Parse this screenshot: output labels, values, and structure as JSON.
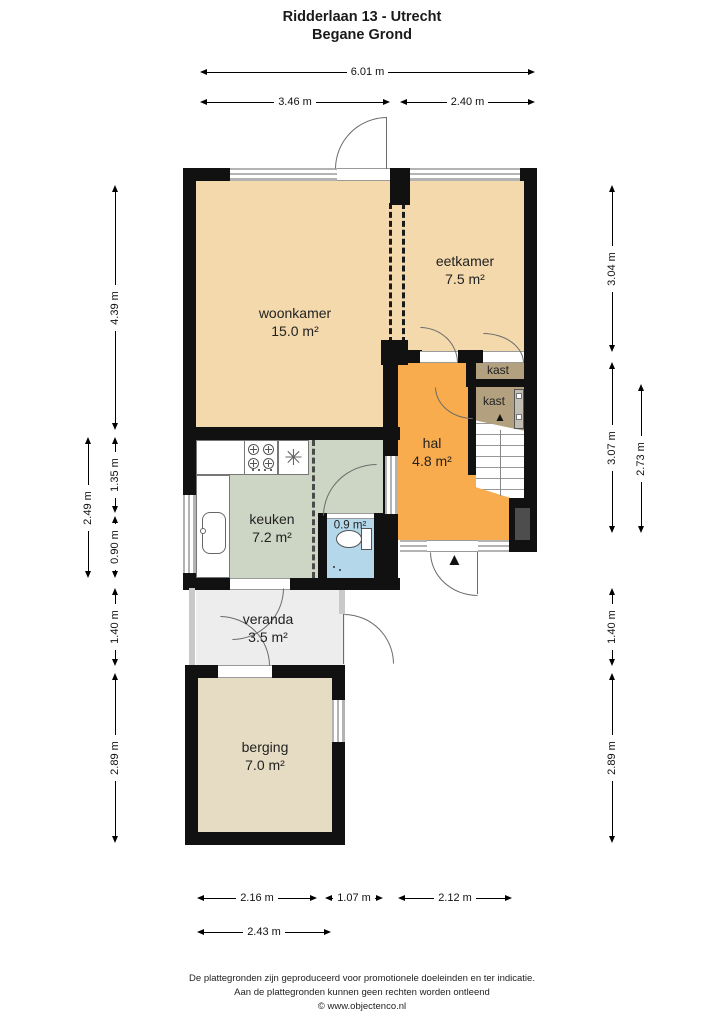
{
  "title": {
    "line1": "Ridderlaan 13 - Utrecht",
    "line2": "Begane Grond"
  },
  "rooms": {
    "woonkamer": {
      "name": "woonkamer",
      "area": "15.0 m²",
      "color": "#f3d9ab"
    },
    "eetkamer": {
      "name": "eetkamer",
      "area": "7.5 m²",
      "color": "#f3d9ab"
    },
    "hal": {
      "name": "hal",
      "area": "4.8 m²",
      "color": "#f9ac4d"
    },
    "kast1": {
      "name": "kast",
      "color": "#b2a07e"
    },
    "kast2": {
      "name": "kast",
      "color": "#b2a07e"
    },
    "keuken": {
      "name": "keuken",
      "area": "7.2 m²",
      "color": "#cdd5c4"
    },
    "toilet": {
      "area": "0.9 m²",
      "color": "#b4d7ea"
    },
    "veranda": {
      "name": "veranda",
      "area": "3.5 m²",
      "color": "#ededed"
    },
    "berging": {
      "name": "berging",
      "area": "7.0 m²",
      "color": "#e6dcc3"
    }
  },
  "dimensions": {
    "top_total": "6.01 m",
    "top_left": "3.46 m",
    "top_right": "2.40 m",
    "left_woonkamer": "4.39 m",
    "left_keuken_total": "2.49 m",
    "left_keuken_upper": "1.35 m",
    "left_keuken_lower": "0.90 m",
    "left_veranda": "1.40 m",
    "left_berging": "2.89 m",
    "right_eetkamer": "3.04 m",
    "right_hal_total": "3.07 m",
    "right_hal_inner": "2.73 m",
    "right_veranda": "1.40 m",
    "right_berging": "2.89 m",
    "bottom_berging_inner": "2.16 m",
    "bottom_middle": "1.07 m",
    "bottom_hal": "2.12 m",
    "bottom_berging_outer": "2.43 m"
  },
  "icons": {
    "stairs_up_arrow": "▲",
    "entrance_arrow": "▲",
    "extractor": "✳"
  },
  "colors": {
    "wall": "#111111",
    "window_frame": "#b3b3b3",
    "door_arc": "#6b6b6b"
  },
  "footer": {
    "line1": "De plattegronden zijn geproduceerd voor promotionele doeleinden en ter indicatie.",
    "line2": "Aan de plattegronden kunnen geen rechten worden ontleend",
    "line3": "© www.objectenco.nl"
  }
}
